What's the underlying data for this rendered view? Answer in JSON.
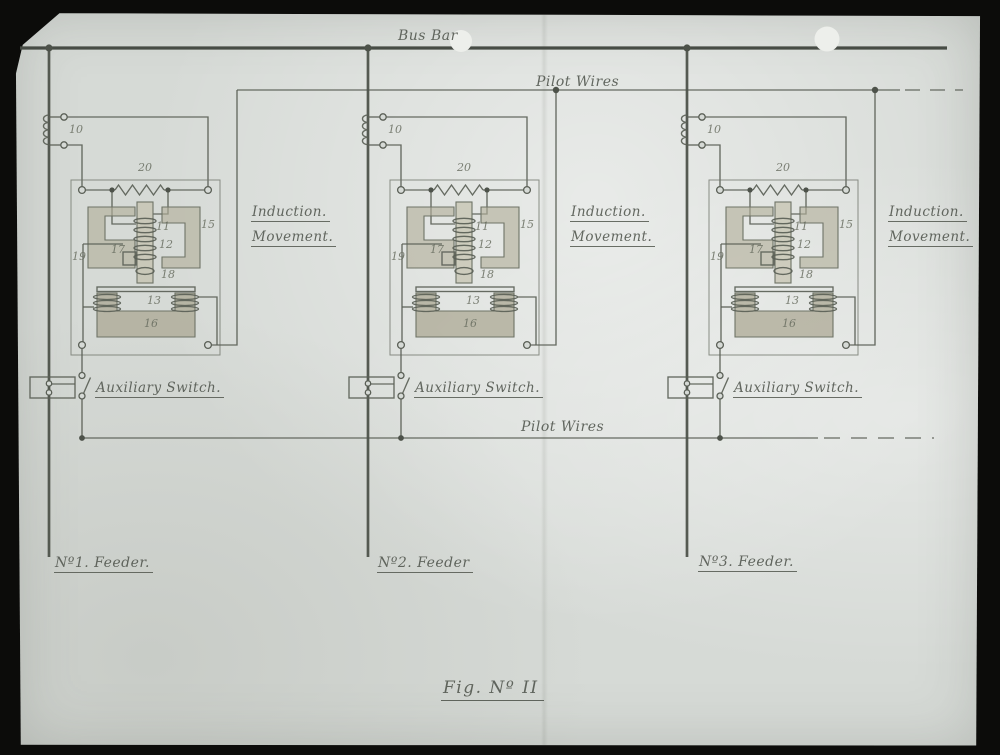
{
  "slide": {
    "bus_bar_label": "Bus Bar",
    "pilot_wires_top_label": "Pilot Wires",
    "pilot_wires_bottom_label": "Pilot Wires",
    "caption": "Fig. Nº II"
  },
  "units": [
    {
      "feeder_label": "Nº1. Feeder.",
      "induction_label": [
        "Induction.",
        "Movement."
      ],
      "aux_switch_label": "Auxiliary Switch.",
      "parts": {
        "series_coil": "10",
        "shunt_resistor": "20",
        "upper_coil_a": "11",
        "upper_coil_b": "12",
        "upper_magnet": "15",
        "left_pole": "17",
        "left_frame": "19",
        "plunger": "18",
        "lower_coil": "13",
        "lower_magnet": "16"
      }
    },
    {
      "feeder_label": "Nº2. Feeder",
      "induction_label": [
        "Induction.",
        "Movement."
      ],
      "aux_switch_label": "Auxiliary Switch.",
      "parts": {
        "series_coil": "10",
        "shunt_resistor": "20",
        "upper_coil_a": "11",
        "upper_coil_b": "12",
        "upper_magnet": "15",
        "left_pole": "17",
        "left_frame": "19",
        "plunger": "18",
        "lower_coil": "13",
        "lower_magnet": "16"
      }
    },
    {
      "feeder_label": "Nº3. Feeder.",
      "induction_label": [
        "Induction.",
        "Movement."
      ],
      "aux_switch_label": "Auxiliary Switch.",
      "parts": {
        "series_coil": "10",
        "shunt_resistor": "20",
        "upper_coil_a": "11",
        "upper_coil_b": "12",
        "upper_magnet": "15",
        "left_pole": "17",
        "left_frame": "19",
        "plunger": "18",
        "lower_coil": "13",
        "lower_magnet": "16"
      }
    }
  ],
  "colors": {
    "slide_mount": "#0c0c0a",
    "paper": "#d6dad6",
    "ink": "#5a5f56",
    "core_shading": "#b2ae99"
  }
}
